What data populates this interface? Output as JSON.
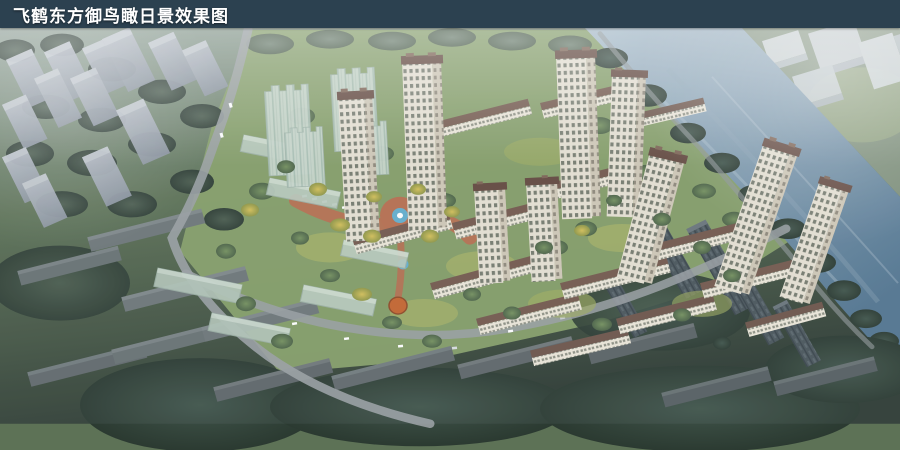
{
  "header": {
    "title": "飞鹤东方御鸟瞰日景效果图"
  },
  "palette": {
    "title_bar_bg": "#2c4150",
    "title_text": "#ffffff",
    "river_top": "#a7bbc9",
    "river_bottom": "#527590",
    "far_bank_grass": "#7d8f79",
    "canopy_dark": "#32423a",
    "canopy_mid": "#5d7851",
    "canopy_yellow": "#c9b655",
    "site_lawn": "#87a069",
    "plaza_paving": "#b66e4f",
    "fountain_water": "#62aecd",
    "pavilion_orange": "#c4652f",
    "tower_facade": "#e6e0d2",
    "tower_roof": "#63493f",
    "glass_tower": "#c8d6cb",
    "context_block": "#a3aab5",
    "dark_block": "#4a555b",
    "road": "#9aa0a3"
  }
}
